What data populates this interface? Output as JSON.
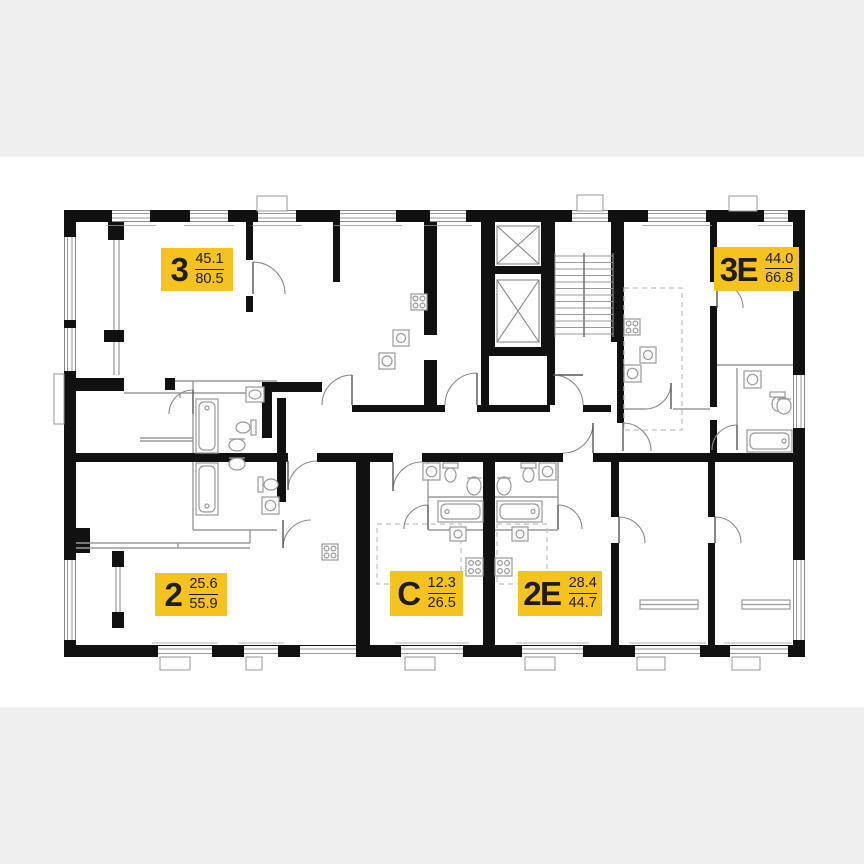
{
  "floor_plan": {
    "units": [
      {
        "label": "3",
        "area_living": "45.1",
        "area_total": "80.5"
      },
      {
        "label": "3Е",
        "area_living": "44.0",
        "area_total": "66.8"
      },
      {
        "label": "2",
        "area_living": "25.6",
        "area_total": "55.9"
      },
      {
        "label": "С",
        "area_living": "12.3",
        "area_total": "26.5"
      },
      {
        "label": "2Е",
        "area_living": "28.4",
        "area_total": "44.7"
      }
    ],
    "colors": {
      "badge_background": "#F5C21E",
      "badge_text": "#1D1D1D",
      "wall": "#111111",
      "line": "#9A9A9A",
      "canvas": "#FFFFFF",
      "page_background": "#EFEFEF"
    },
    "icons": [
      "elevator-shaft-icon",
      "stairs-icon",
      "bathtub-icon",
      "toilet-icon",
      "sink-icon",
      "stove-icon",
      "washing-machine-icon",
      "door-arc-icon",
      "window-icon",
      "radiator-icon",
      "vent-shaft-icon"
    ]
  }
}
